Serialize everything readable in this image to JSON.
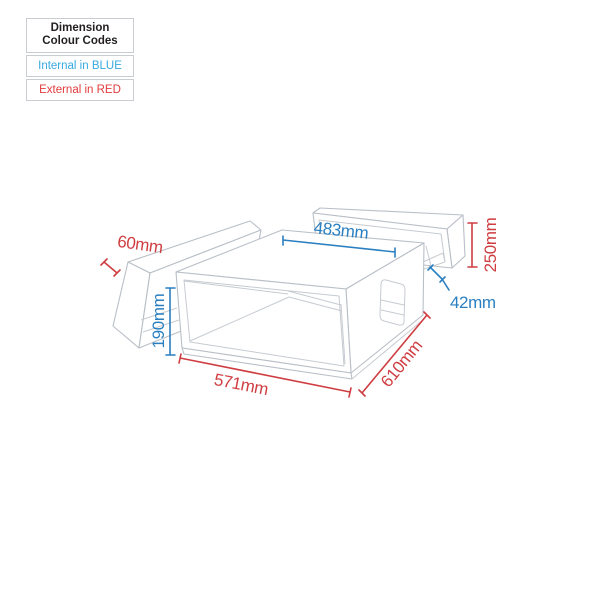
{
  "legend": {
    "title_line1": "Dimension",
    "title_line2": "Colour Codes",
    "internal_label": "Internal in BLUE",
    "external_label": "External in RED",
    "internal_color": "#36a9e1",
    "external_color": "#e23b3e"
  },
  "colors": {
    "internal_dimension": "#2a7fc1",
    "external_dimension": "#cf3d41",
    "line_art": "#c0c5cc"
  },
  "dims": {
    "internal_width": {
      "label": "483mm",
      "value": 483,
      "unit": "mm",
      "type": "internal"
    },
    "internal_height": {
      "label": "190mm",
      "value": 190,
      "unit": "mm",
      "type": "internal"
    },
    "internal_rear_depth": {
      "label": "42mm",
      "value": 42,
      "unit": "mm",
      "type": "internal"
    },
    "external_front_depth": {
      "label": "60mm",
      "value": 60,
      "unit": "mm",
      "type": "external"
    },
    "external_height": {
      "label": "250mm",
      "value": 250,
      "unit": "mm",
      "type": "external"
    },
    "external_width": {
      "label": "571mm",
      "value": 571,
      "unit": "mm",
      "type": "external"
    },
    "external_depth": {
      "label": "610mm",
      "value": 610,
      "unit": "mm",
      "type": "external"
    }
  }
}
